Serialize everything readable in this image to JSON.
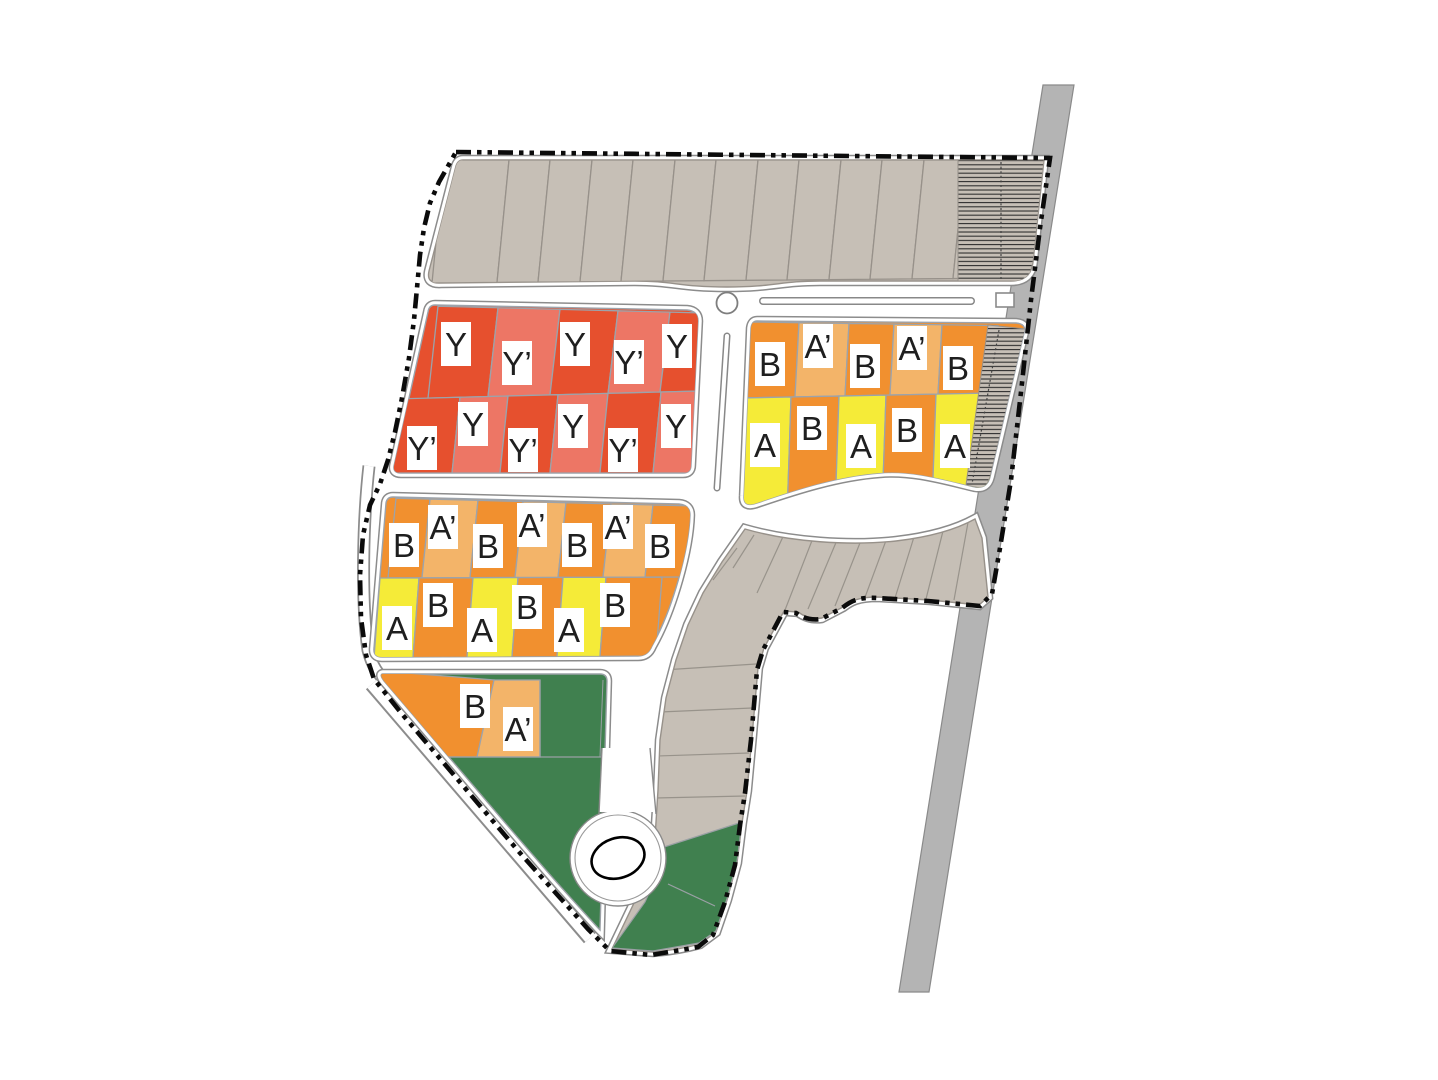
{
  "figure": {
    "type": "site-plan",
    "description": "residential subdivision plot plan"
  },
  "palette": {
    "dark_red": "#E6502E",
    "salmon": "#ED7665",
    "orange": "#F1902F",
    "light_orange": "#F3B469",
    "yellow": "#F5EB38",
    "green": "#40804F",
    "gray_lot": "#C6BFB6",
    "road_gray": "#B4B4B4",
    "boundary_black": "#0B0B0B",
    "lot_border": "#9CA3AB",
    "label_text": "#1F1F1F",
    "label_box": "#FFFFFF"
  },
  "blocks": {
    "north_block": {
      "lot_count": 13,
      "hatched_strip": true,
      "labels": []
    },
    "y_block": {
      "rows": [
        {
          "labels": [
            "Y",
            "Y’",
            "Y",
            "Y’",
            "Y"
          ],
          "colors": [
            "dark_red",
            "salmon",
            "dark_red",
            "salmon",
            "dark_red"
          ]
        },
        {
          "labels": [
            "Y’",
            "Y",
            "Y’",
            "Y",
            "Y’",
            "Y"
          ],
          "colors": [
            "dark_red",
            "salmon",
            "dark_red",
            "salmon",
            "dark_red",
            "salmon"
          ]
        }
      ]
    },
    "mid_block": {
      "rows": [
        {
          "labels": [
            "B",
            "A’",
            "B",
            "A’",
            "B",
            "A’",
            "B"
          ],
          "colors": [
            "orange",
            "light_orange",
            "orange",
            "light_orange",
            "orange",
            "light_orange",
            "orange"
          ]
        },
        {
          "labels": [
            "A",
            "B",
            "A",
            "B",
            "A",
            "B"
          ],
          "colors": [
            "yellow",
            "orange",
            "yellow",
            "orange",
            "yellow",
            "orange"
          ]
        }
      ]
    },
    "east_block": {
      "rows": [
        {
          "labels": [
            "B",
            "A’",
            "B",
            "A’",
            "B"
          ],
          "colors": [
            "orange",
            "light_orange",
            "orange",
            "light_orange",
            "orange"
          ]
        },
        {
          "labels": [
            "A",
            "B",
            "A",
            "B",
            "A"
          ],
          "colors": [
            "yellow",
            "orange",
            "yellow",
            "orange",
            "yellow"
          ]
        }
      ],
      "hatched_strip": true
    },
    "south_block": {
      "labels": [
        "B",
        "A’"
      ],
      "colors": [
        "orange",
        "light_orange"
      ]
    },
    "crescent_block": {
      "lot_count": 18,
      "labels": []
    }
  },
  "features": {
    "roundabout": true,
    "cul_de_sac_island": true,
    "medians": 2,
    "gate_rectangle": true,
    "green_areas": 4,
    "highway_strip": true,
    "boundary_style": "dash-dot-dot"
  }
}
